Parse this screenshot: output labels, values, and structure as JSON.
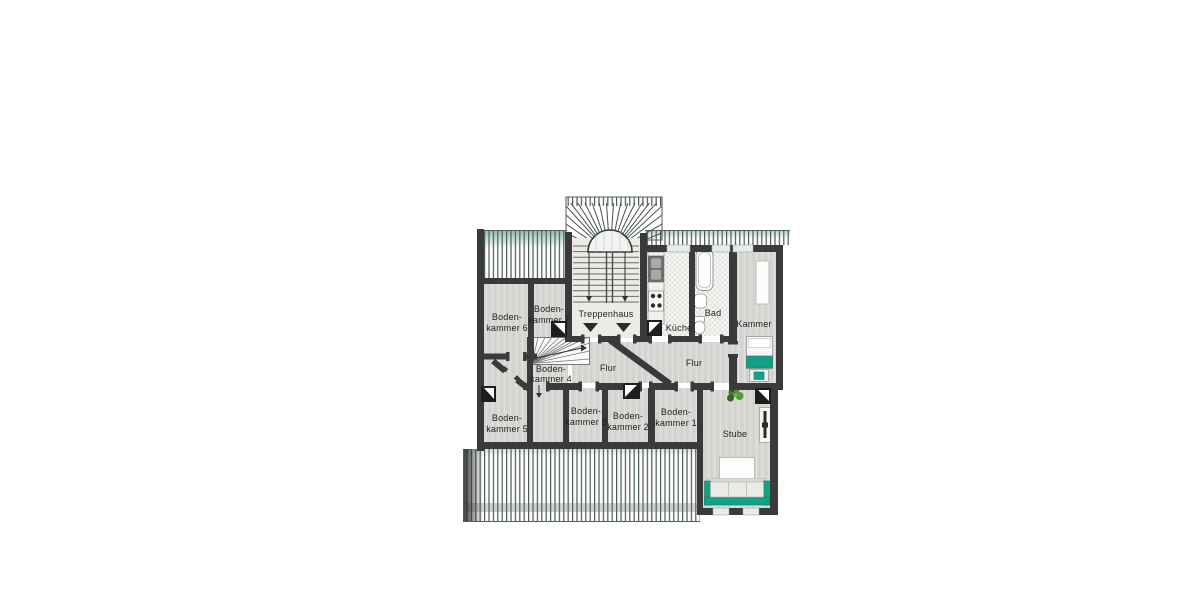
{
  "plan": {
    "rooms": {
      "bodenkammer6": {
        "line1": "Boden-",
        "line2": "kammer 6"
      },
      "bodenkammer7": {
        "line1": "Boden-",
        "line2": "kammer 7"
      },
      "treppenhaus": {
        "label": "Treppenhaus"
      },
      "kueche": {
        "label": "Küche"
      },
      "bad": {
        "label": "Bad"
      },
      "kammer": {
        "label": "Kammer"
      },
      "bodenkammer4": {
        "line1": "Boden-",
        "line2": "kammer 4"
      },
      "flur_left": {
        "label": "Flur"
      },
      "flur_right": {
        "label": "Flur"
      },
      "bodenkammer5": {
        "line1": "Boden-",
        "line2": "kammer 5"
      },
      "bodenkammer3": {
        "line1": "Boden-",
        "line2": "kammer 3"
      },
      "bodenkammer2": {
        "line1": "Boden-",
        "line2": "kammer 2"
      },
      "bodenkammer1": {
        "line1": "Boden-",
        "line2": "kammer 1"
      },
      "stube": {
        "label": "Stube"
      }
    },
    "colors": {
      "wall": "#3a3a3a",
      "floor": "#d8d6d3",
      "floor_light": "#ecebe8",
      "tile": "#f6f5f2",
      "stripe": "#4d5a56",
      "accent": "#14a085",
      "accent_dark": "#0d7d66",
      "window": "#e4ede9",
      "plant": "#4c8a35",
      "label_text": "#1f1f1f"
    }
  }
}
